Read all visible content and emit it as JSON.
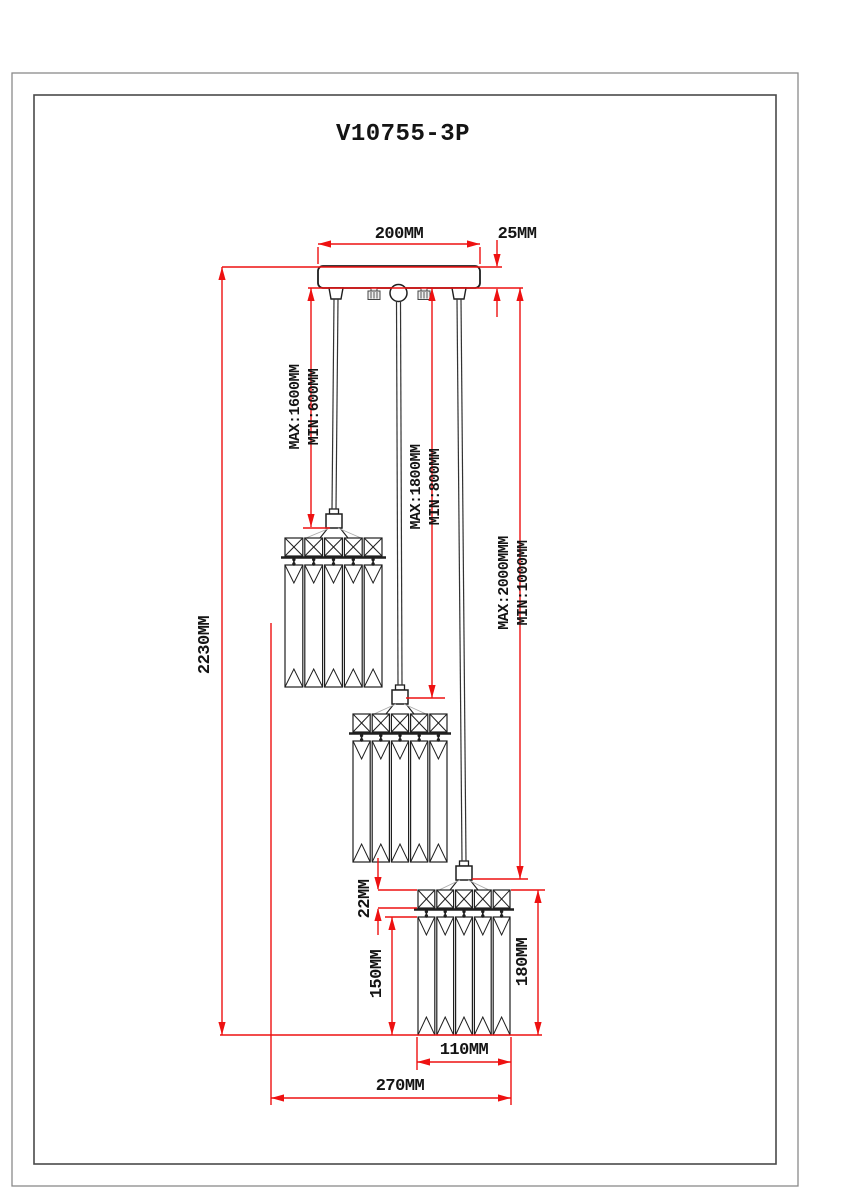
{
  "title": "V10755-3P",
  "dimensions": {
    "canopy_width": "200MM",
    "canopy_height": "25MM",
    "overall_drop": "2230MM",
    "pendant1": {
      "max": "MAX:1600MM",
      "min": "MIN:600MM"
    },
    "pendant2": {
      "max": "MAX:1800MM",
      "min": "MIN:800MM"
    },
    "pendant3": {
      "max": "MAX:2000MMM",
      "min": "MIN:1000MM"
    },
    "shade_band_height": "22MM",
    "shade_prism_height": "150MM",
    "shade_total_height": "180MM",
    "shade_width": "110MM",
    "cluster_span": "270MM"
  },
  "colors": {
    "dimension_line": "#ee1111",
    "drawing_line": "#1f1f1f",
    "frame_line": "#555555"
  }
}
